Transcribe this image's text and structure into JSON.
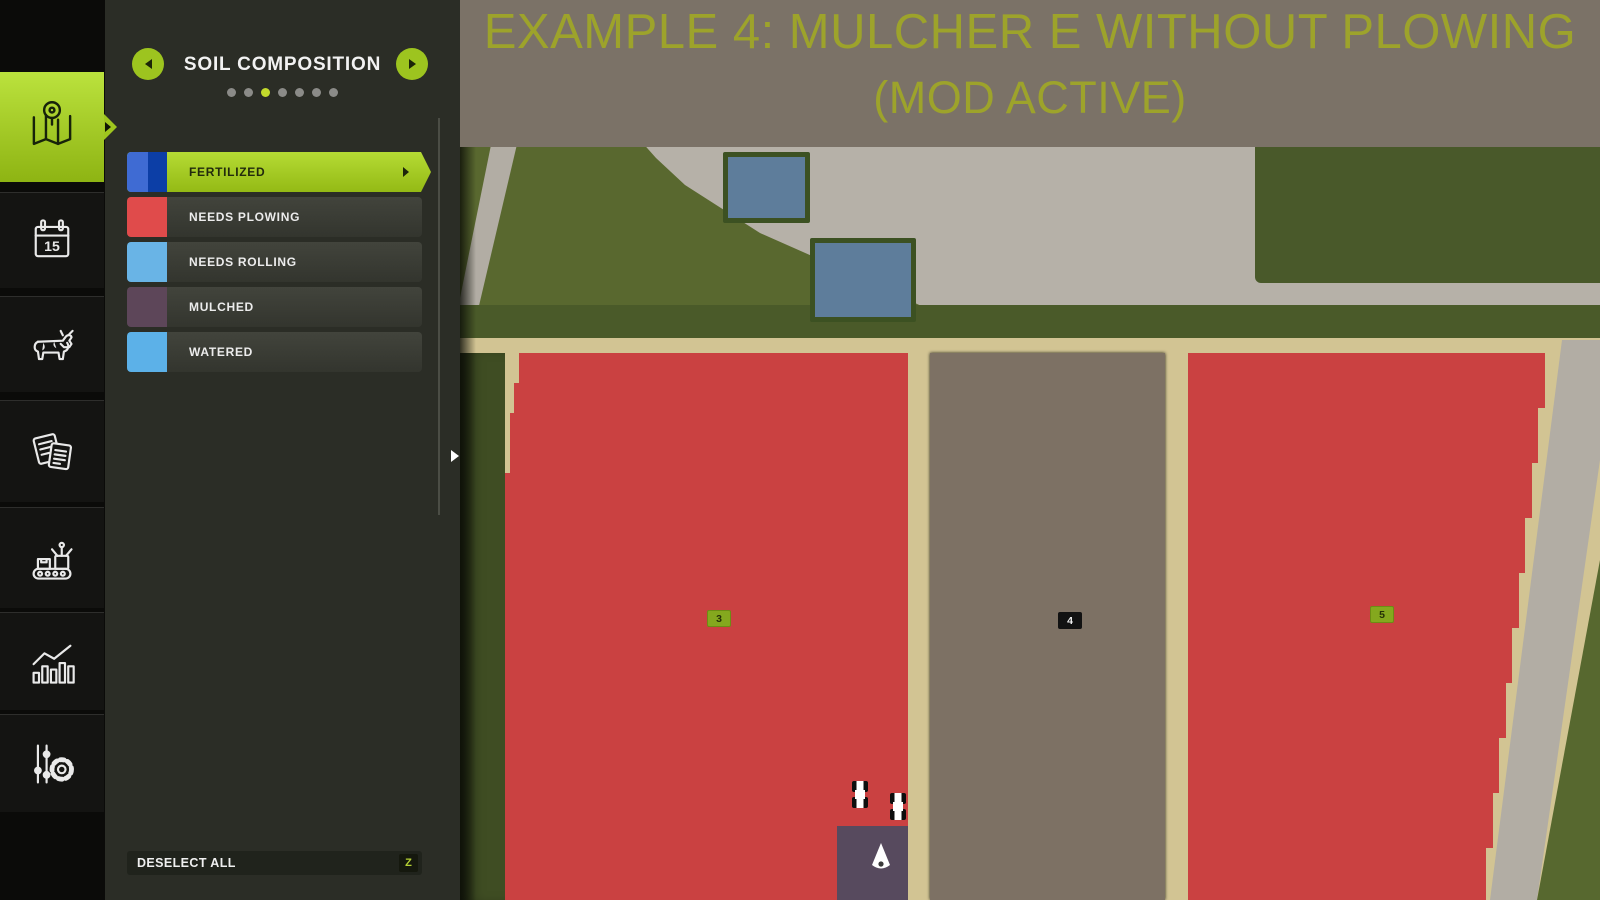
{
  "banner": {
    "line1": "EXAMPLE 4: MULCHER E WITHOUT PLOWING",
    "line2": "(MOD ACTIVE)",
    "background": "#7b7267",
    "text_color": "#9da32b"
  },
  "sidebar": {
    "items": [
      {
        "id": "map",
        "icon": "map-pin-icon",
        "selected": true
      },
      {
        "id": "calendar",
        "icon": "calendar-icon",
        "day_label": "15",
        "selected": false
      },
      {
        "id": "animals",
        "icon": "cow-icon",
        "selected": false
      },
      {
        "id": "contracts",
        "icon": "documents-icon",
        "selected": false
      },
      {
        "id": "production",
        "icon": "production-line-icon",
        "selected": false
      },
      {
        "id": "statistics",
        "icon": "bar-chart-icon",
        "selected": false
      },
      {
        "id": "settings",
        "icon": "sliders-gear-icon",
        "selected": false
      }
    ]
  },
  "panel": {
    "title": "SOIL COMPOSITION",
    "pager": {
      "dot_count": 7,
      "active_index": 2
    },
    "legend": [
      {
        "label": "FERTILIZED",
        "selected": true,
        "swatch_colors": [
          "#3f6bd3",
          "#0c3ea6"
        ]
      },
      {
        "label": "NEEDS PLOWING",
        "selected": false,
        "swatch_colors": [
          "#e04b4b"
        ]
      },
      {
        "label": "NEEDS ROLLING",
        "selected": false,
        "swatch_colors": [
          "#69b4e6"
        ]
      },
      {
        "label": "MULCHED",
        "selected": false,
        "swatch_colors": [
          "#5d4659"
        ]
      },
      {
        "label": "WATERED",
        "selected": false,
        "swatch_colors": [
          "#5cb1e8"
        ]
      }
    ],
    "deselect_button": {
      "label": "DESELECT ALL",
      "hotkey": "Z"
    }
  },
  "map": {
    "field_badges": [
      {
        "number": "3",
        "style": "owned"
      },
      {
        "number": "4",
        "style": "unowned"
      },
      {
        "number": "5",
        "style": "owned"
      }
    ],
    "overlay_colors": {
      "needs_plowing_red": "#ca4141",
      "unowned_field_brown": "#7d7164",
      "mulched_purple": "#574a5e",
      "road_tan": "#d2c493",
      "gravel_gray": "#b6b1a8",
      "grass_green": "#59682f"
    },
    "vehicle_count": 2
  }
}
